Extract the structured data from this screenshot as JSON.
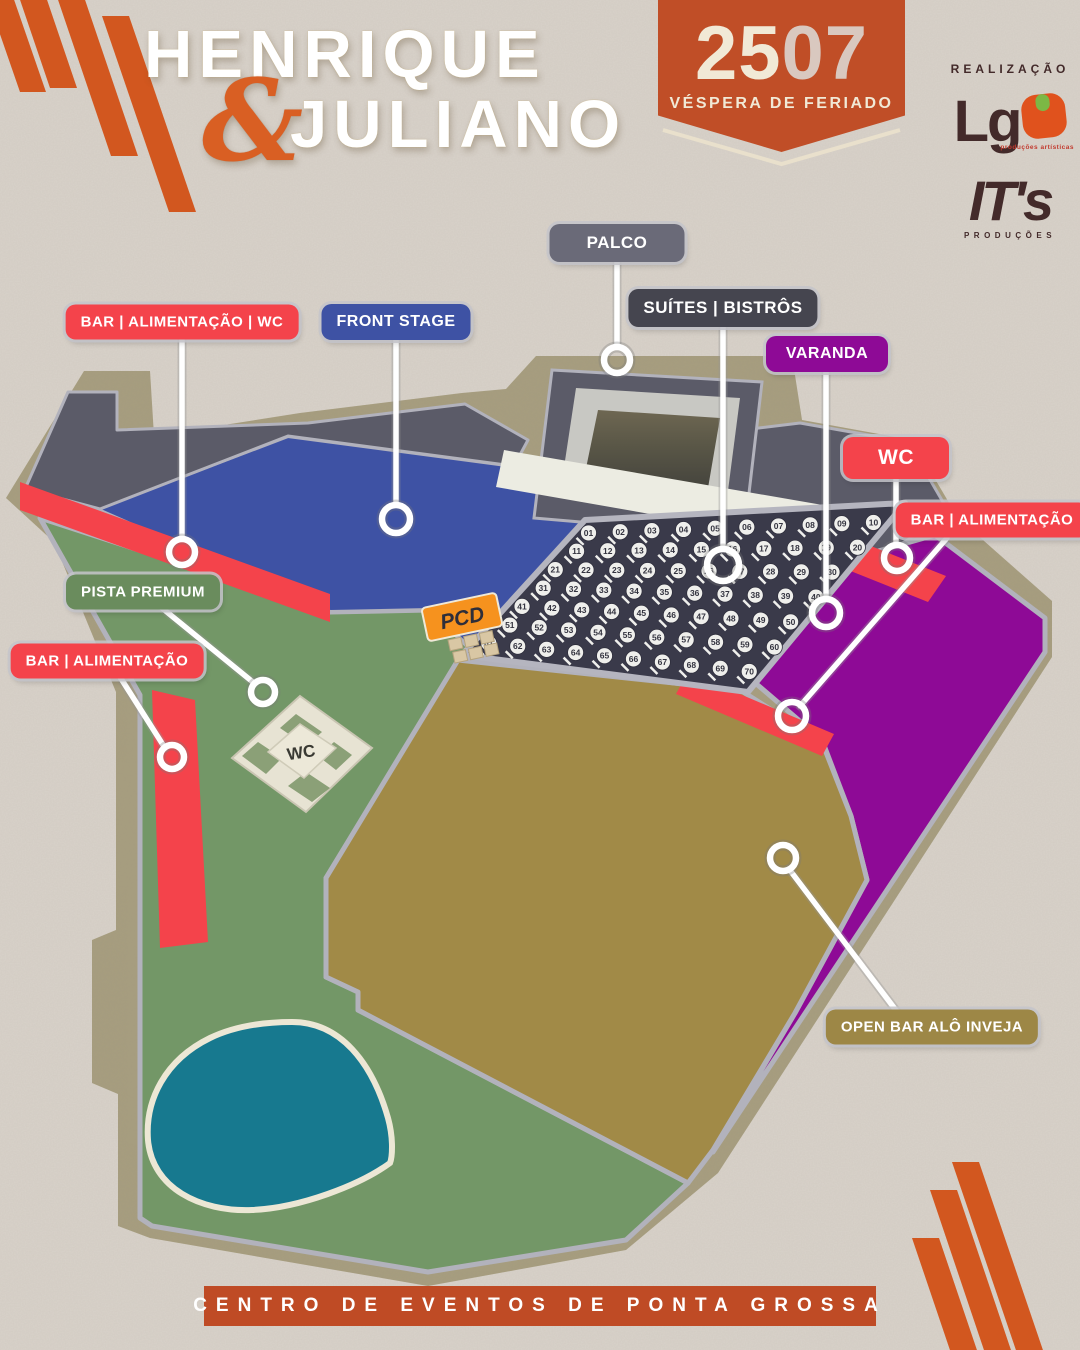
{
  "header": {
    "artist": {
      "line1": "HENRIQUE",
      "ampersand": "&",
      "line2": "JULIANO"
    },
    "date_badge": {
      "day": "25",
      "month": "07",
      "caption": "VÉSPERA DE FERIADO"
    },
    "realization": {
      "title": "REALIZAÇÃO",
      "logo1_text": "Lg",
      "logo1_sub": "produções artísticas",
      "logo2_text": "IT's",
      "logo2_sub": "PRODUÇÕES"
    }
  },
  "map": {
    "legend_labels": [
      {
        "id": "palco",
        "text": "PALCO",
        "color": "#6a6a78",
        "cx": 617,
        "cy": 243,
        "fs": 17,
        "minw": 105
      },
      {
        "id": "suites-bistros",
        "text": "SUÍTES | BISTRÔS",
        "color": "#45454f",
        "cx": 723,
        "cy": 308,
        "fs": 17,
        "minw": 0
      },
      {
        "id": "varanda",
        "text": "VARANDA",
        "color": "#8e0a96",
        "cx": 827,
        "cy": 354,
        "fs": 16,
        "minw": 92
      },
      {
        "id": "front-stage",
        "text": "FRONT STAGE",
        "color": "#3e52a4",
        "cx": 396,
        "cy": 322,
        "fs": 16,
        "minw": 0
      },
      {
        "id": "bar-alimentacao-wc",
        "text": "BAR | ALIMENTAÇÃO | WC",
        "color": "#f4434b",
        "cx": 182,
        "cy": 322,
        "fs": 15,
        "minw": 0
      },
      {
        "id": "wc",
        "text": "WC",
        "color": "#f4434b",
        "cx": 896,
        "cy": 458,
        "fs": 21,
        "minw": 76
      },
      {
        "id": "bar-alimentacao-direita",
        "text": "BAR | ALIMENTAÇÃO",
        "color": "#f4434b",
        "cx": 992,
        "cy": 520,
        "fs": 15,
        "minw": 0
      },
      {
        "id": "pista-premium",
        "text": "PISTA PREMIUM",
        "color": "#6a8c5d",
        "cx": 143,
        "cy": 592,
        "fs": 15,
        "minw": 0
      },
      {
        "id": "bar-alimentacao-esquerda",
        "text": "BAR | ALIMENTAÇÃO",
        "color": "#f4434b",
        "cx": 107,
        "cy": 661,
        "fs": 15,
        "minw": 0
      },
      {
        "id": "open-bar-alo-inveja",
        "text": "OPEN BAR ALÔ INVEJA",
        "color": "#9d8746",
        "cx": 932,
        "cy": 1027,
        "fs": 15,
        "minw": 0
      }
    ],
    "area_tags": {
      "pcd": "PCD",
      "wc_building": "WC"
    },
    "suites_tables": {
      "rows": 7,
      "per_row": 10,
      "start": 1
    }
  },
  "footer": {
    "venue_name": "CENTRO DE EVENTOS DE PONTA GROSSA"
  },
  "colors": {
    "background": "#d8d2ca",
    "stripes_orange": "#d2571f",
    "path_khaki": "#a79e7f",
    "front_stage_blue": "#3e52a4",
    "pista_premium_green": "#739767",
    "open_bar_gold": "#a18a47",
    "varanda_purple": "#8e0a96",
    "bar_red": "#f4434b",
    "stage_gray": "#5b5b68",
    "suites_dark": "#3a3a4a",
    "pond_teal": "#17798f",
    "badge_orange": "#c04e27",
    "banner_rust": "#bf4b25",
    "logo_brown": "#432a2a"
  }
}
